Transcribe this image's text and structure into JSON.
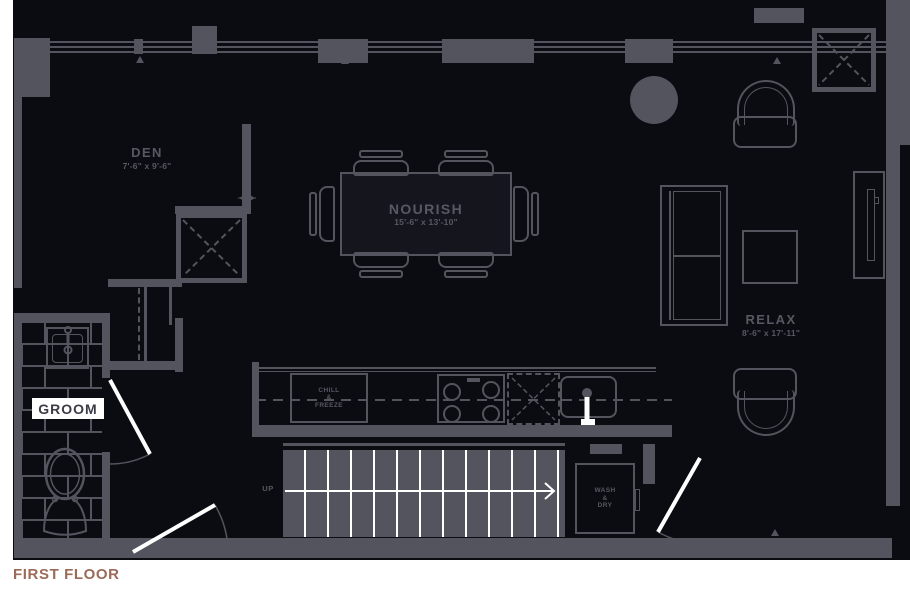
{
  "plan": {
    "floor_label": "FIRST FLOOR",
    "rooms": {
      "den": {
        "name": "DEN",
        "dims": "7'-6\" x 9'-6\""
      },
      "nourish": {
        "name": "NOURISH",
        "dims": "15'-6\" x 13'-10\""
      },
      "relax": {
        "name": "RELAX",
        "dims": "8'-6\" x 17'-11\""
      },
      "groom": {
        "name": "GROOM"
      }
    },
    "labels": {
      "fridge": "CHILL\n&\nFREEZE",
      "laundry": "WASH\n&\nDRY",
      "stairs_up": "UP"
    },
    "colors": {
      "page_bg": "#ffffff",
      "floor_bg": "#0b0b12",
      "wall": "#54545e",
      "door_leaf": "#ffffff",
      "stair_tread": "#ffffff",
      "title_accent": "#9c6a58",
      "groom_box_bg": "#ffffff",
      "groom_text": "#3c3c46"
    }
  }
}
